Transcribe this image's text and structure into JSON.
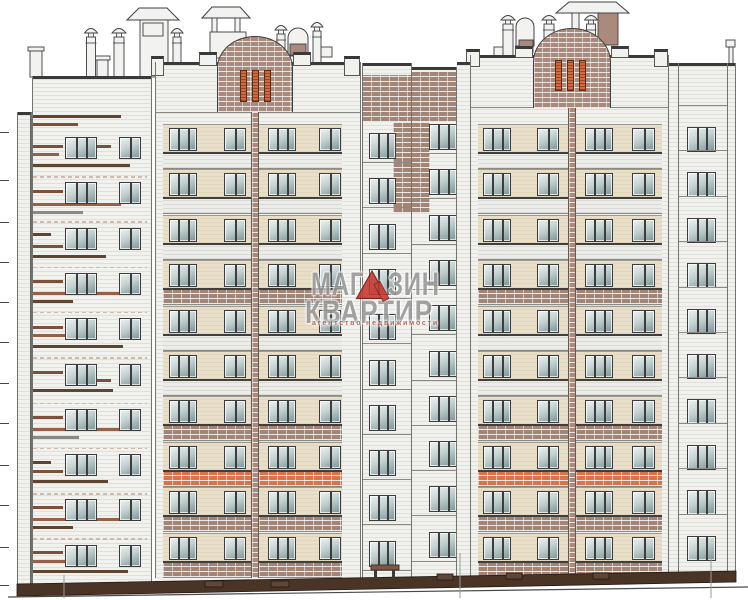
{
  "watermark": {
    "line1_left": "МАГ",
    "line1_right": "ЗИН",
    "line2": "КВАРТИР",
    "line3": "агентство  недвижимости",
    "accent_red": "#c7362d",
    "accent_red_dark": "#6e1812",
    "text_gray": "#989898",
    "subtitle_color": "#a85848"
  },
  "palette": {
    "white_brick": "#f1f1ee",
    "cream_band": "#e9dfc8",
    "brick_brown": "#a18677",
    "brick_orange": "#d8734a",
    "brick_pediment": "#a98a7c",
    "base_brown": "#4a3426",
    "line_dark": "#3a3a3a",
    "glass_light": "#eef2f2",
    "glass_dark": "#7b9496",
    "roof_white": "#f2f2f0",
    "roof_stroke": "#3f3f3f"
  },
  "structure": {
    "canvas": {
      "w": 748,
      "h": 600
    },
    "drawing_type": "residential-building-front-elevation",
    "grid": {
      "floors": 10,
      "bandTop": 124,
      "floorH": 45.4,
      "creamH": 28,
      "balcH": 17
    },
    "balcony_pattern": [
      "white",
      "white",
      "white",
      "brick",
      "white",
      "white",
      "brick",
      "orange",
      "brick",
      "brick"
    ],
    "gable": {
      "x": 17,
      "y": 112,
      "w": 14,
      "h": 472
    },
    "left_wing": {
      "x": 32,
      "y": 76,
      "w": 120,
      "h": 508,
      "rowY0": 137,
      "rowDY": 45.3,
      "winH": 22,
      "windows": [
        [
          65,
          32,
          3
        ],
        [
          119,
          22,
          2
        ]
      ],
      "dashY0": 176,
      "stripes": [
        [
          115,
          33,
          88,
          "sd"
        ],
        [
          123,
          33,
          45,
          "sm"
        ],
        [
          145,
          33,
          30,
          "sm"
        ],
        [
          145,
          97,
          14,
          "sm"
        ],
        [
          153,
          33,
          26,
          "sr"
        ],
        [
          164,
          33,
          97,
          "sd"
        ],
        [
          190,
          33,
          30,
          "sm"
        ],
        [
          203,
          33,
          88,
          "sr"
        ],
        [
          211,
          33,
          50,
          "sg"
        ],
        [
          233,
          33,
          18,
          "sd"
        ],
        [
          245,
          33,
          30,
          "sm"
        ],
        [
          255,
          33,
          73,
          "sd"
        ],
        [
          280,
          33,
          30,
          "sm"
        ],
        [
          292,
          33,
          88,
          "sr"
        ],
        [
          300,
          33,
          40,
          "sd"
        ],
        [
          326,
          33,
          30,
          "sm"
        ],
        [
          334,
          33,
          55,
          "sr"
        ],
        [
          345,
          33,
          90,
          "sd"
        ],
        [
          371,
          33,
          30,
          "sm"
        ],
        [
          379,
          97,
          14,
          "sm"
        ],
        [
          389,
          33,
          80,
          "sd"
        ],
        [
          416,
          33,
          30,
          "sm"
        ],
        [
          428,
          33,
          88,
          "sr"
        ],
        [
          436,
          33,
          46,
          "sg"
        ],
        [
          461,
          33,
          18,
          "sd"
        ],
        [
          470,
          33,
          30,
          "sm"
        ],
        [
          480,
          33,
          75,
          "sd"
        ],
        [
          506,
          33,
          30,
          "sm"
        ],
        [
          518,
          33,
          88,
          "sr"
        ],
        [
          526,
          33,
          40,
          "sd"
        ],
        [
          551,
          33,
          30,
          "sm"
        ],
        [
          560,
          33,
          55,
          "sr"
        ],
        [
          570,
          33,
          95,
          "sd"
        ]
      ]
    },
    "towers": [
      {
        "x": 155,
        "w": 205,
        "capY": 62,
        "corniceY": 112,
        "blocks": [
          [
            151,
            56,
            13,
            20
          ],
          [
            199,
            52,
            18,
            14
          ],
          [
            293,
            52,
            18,
            14
          ],
          [
            344,
            56,
            16,
            20
          ]
        ],
        "pediment": {
          "x": 217,
          "y": 36,
          "w": 76,
          "h": 76,
          "slits": [
            [
              240,
              70,
              7,
              32
            ],
            [
              252,
              70,
              7,
              32
            ],
            [
              264,
              70,
              7,
              32
            ]
          ]
        },
        "stripe": {
          "x": 251,
          "y": 112,
          "w": 8
        },
        "bays": [
          {
            "x": 163,
            "w": 88,
            "windows": [
              [
                169,
                28,
                3
              ],
              [
                224,
                22,
                2
              ]
            ]
          },
          {
            "x": 259,
            "w": 83,
            "windows": [
              [
                268,
                28,
                3
              ],
              [
                319,
                22,
                2
              ]
            ]
          }
        ]
      },
      {
        "x": 470,
        "w": 198,
        "capY": 55,
        "corniceY": 107,
        "blocks": [
          [
            466,
            49,
            14,
            18
          ],
          [
            515,
            46,
            18,
            12
          ],
          [
            611,
            46,
            18,
            12
          ],
          [
            654,
            49,
            14,
            18
          ]
        ],
        "pediment": {
          "x": 533,
          "y": 28,
          "w": 78,
          "h": 80,
          "slits": [
            [
              555,
              60,
              7,
              31
            ],
            [
              567,
              60,
              7,
              31
            ],
            [
              579,
              60,
              7,
              31
            ]
          ]
        },
        "stripe": {
          "x": 568,
          "y": 107,
          "w": 8
        },
        "bays": [
          {
            "x": 478,
            "w": 90,
            "windows": [
              [
                483,
                28,
                3
              ],
              [
                537,
                22,
                2
              ]
            ]
          },
          {
            "x": 576,
            "w": 86,
            "windows": [
              [
                585,
                28,
                3
              ],
              [
                632,
                23,
                2
              ]
            ]
          }
        ]
      }
    ],
    "mid_columns": [
      {
        "x": 362,
        "w": 49,
        "capY": 63,
        "band": [
          75,
          47
        ],
        "patch": [
          393,
          122,
          18,
          91
        ],
        "win": {
          "x": 369,
          "w": 27,
          "panes": 3,
          "y0": 133,
          "dy": 45.3,
          "h": 26
        },
        "divDY": 29
      },
      {
        "x": 411,
        "w": 46,
        "capY": 67,
        "band": [
          72,
          50
        ],
        "patch": [
          411,
          122,
          19,
          91
        ],
        "win": {
          "x": 429,
          "w": 28,
          "panes": 3,
          "y0": 124,
          "dy": 45.3,
          "h": 26
        },
        "divDY": 30
      }
    ],
    "gap_strip": {
      "x": 457,
      "y": 62,
      "w": 13,
      "h": 520
    },
    "right_wing": {
      "x": 668,
      "y": 63,
      "w": 68,
      "win": {
        "x": 687,
        "w": 29,
        "panes": 3,
        "y0": 127,
        "dy": 45.4,
        "h": 25
      },
      "divUp": 22
    },
    "vlines": [
      [
        17,
        112,
        584
      ],
      [
        31,
        112,
        584
      ],
      [
        32,
        76,
        584
      ],
      [
        151,
        76,
        584
      ],
      [
        155,
        62,
        578
      ],
      [
        360,
        62,
        578
      ],
      [
        362,
        63,
        580
      ],
      [
        411,
        63,
        580
      ],
      [
        456,
        67,
        580
      ],
      [
        470,
        55,
        578
      ],
      [
        668,
        55,
        578
      ],
      [
        678,
        63,
        574
      ],
      [
        727,
        63,
        574
      ],
      [
        735,
        63,
        574
      ]
    ],
    "ticks": {
      "x": 0,
      "len": 9,
      "ys": [
        132,
        180,
        222,
        262,
        302,
        342,
        383,
        423,
        465,
        505,
        547,
        585
      ]
    },
    "base": {
      "poly": "17,584 736,571 736,582 17,596",
      "ground": [
        8,
        597,
        748,
        587
      ],
      "vents": [
        [
          205,
          581,
          18,
          6
        ],
        [
          271,
          581,
          18,
          6
        ],
        [
          437,
          574,
          16,
          6
        ],
        [
          506,
          573,
          16,
          6
        ],
        [
          593,
          573,
          16,
          6
        ]
      ],
      "bench": {
        "seat": [
          371,
          565,
          28,
          5
        ],
        "legs": [
          [
            374,
            570,
            3,
            9
          ],
          [
            392,
            570,
            3,
            9
          ]
        ]
      },
      "downspouts": [
        [
          64,
          575,
          598
        ],
        [
          460,
          553,
          598
        ],
        [
          711,
          556,
          598
        ]
      ]
    },
    "roof": {
      "hats": [
        [
          [
            127,
            20
          ],
          [
            139,
            8
          ],
          [
            167,
            8
          ],
          [
            179,
            20
          ]
        ],
        [
          [
            202,
            18
          ],
          [
            212,
            7
          ],
          [
            240,
            7
          ],
          [
            250,
            18
          ]
        ],
        [
          [
            556,
            13
          ],
          [
            569,
            2
          ],
          [
            616,
            2
          ],
          [
            629,
            13
          ]
        ]
      ],
      "white_rects": [
        [
          140,
          20,
          28,
          57
        ],
        [
          143,
          23,
          20,
          13
        ],
        [
          212,
          18,
          5,
          14
        ],
        [
          235,
          18,
          5,
          14
        ],
        [
          210,
          32,
          36,
          26
        ],
        [
          572,
          13,
          7,
          32
        ],
        [
          610,
          13,
          7,
          32
        ],
        [
          494,
          47,
          13,
          10
        ],
        [
          314,
          47,
          18,
          10
        ],
        [
          726,
          40,
          9,
          7
        ],
        [
          729,
          47,
          4,
          17
        ]
      ],
      "brick_rects": [
        [
          598,
          13,
          20,
          32
        ],
        [
          290,
          44,
          16,
          11
        ],
        [
          519,
          40,
          14,
          13
        ]
      ],
      "stacks": [
        [
          30,
          47,
          12,
          26
        ],
        [
          97,
          56,
          11,
          18
        ]
      ],
      "domes": [
        [
          91,
          27,
          13,
          40
        ],
        [
          119,
          27,
          14,
          40
        ],
        [
          177,
          27,
          12,
          26
        ],
        [
          281,
          24,
          12,
          24
        ],
        [
          317,
          21,
          12,
          38
        ],
        [
          508,
          14,
          14,
          39
        ],
        [
          549,
          14,
          14,
          35
        ],
        [
          591,
          14,
          13,
          27
        ]
      ],
      "arches": [
        [
          288,
          28,
          20,
          28
        ],
        [
          516,
          18,
          18,
          28
        ]
      ]
    }
  }
}
